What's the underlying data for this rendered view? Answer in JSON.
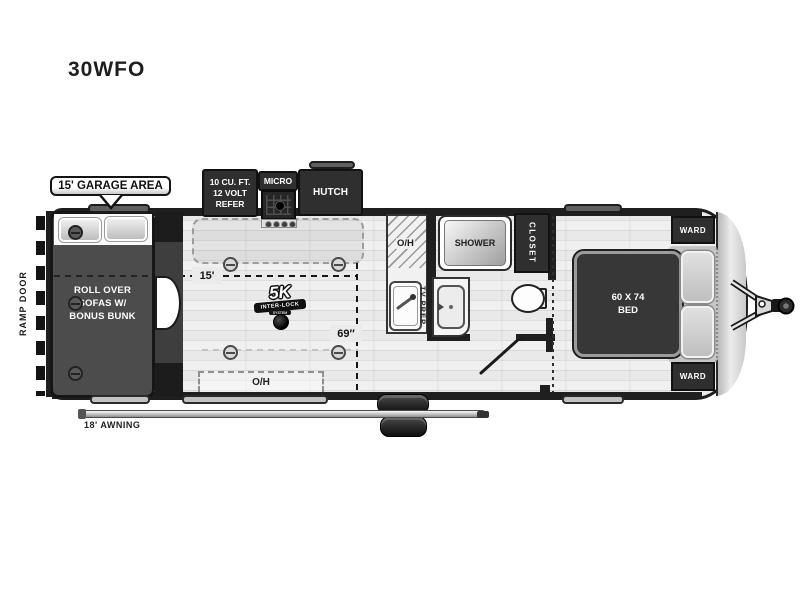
{
  "title": "30WFO",
  "callout": {
    "garage_area": "15' GARAGE AREA"
  },
  "dimensions": {
    "garage_length": "15'",
    "garage_width": "69″",
    "awning": "18' AWNING"
  },
  "labels": {
    "ramp_door": "RAMP DOOR",
    "refer_lines": [
      "10 CU. FT.",
      "12 VOLT",
      "REFER"
    ],
    "micro": "MICRO",
    "hutch": "HUTCH",
    "overhead": "O/H",
    "shower": "SHOWER",
    "closet": "CLOSET",
    "tv_prep": "TV PREP",
    "ward": "WARD",
    "bed_lines": [
      "60 X 74",
      "BED"
    ],
    "garage_lines": [
      "ROLL OVER",
      "SOFAS W/",
      "BONUS BUNK"
    ]
  },
  "badge": {
    "top": "5K",
    "middle": "INTER-LOCK",
    "bottom": "SYSTEM"
  },
  "colors": {
    "wall_dark": "#1f1f1f",
    "furniture_dark": "#2f2f2f",
    "garage_floor": "#4c4c4c",
    "floor_light": "#e9e9e9",
    "accent_white": "#ffffff"
  }
}
